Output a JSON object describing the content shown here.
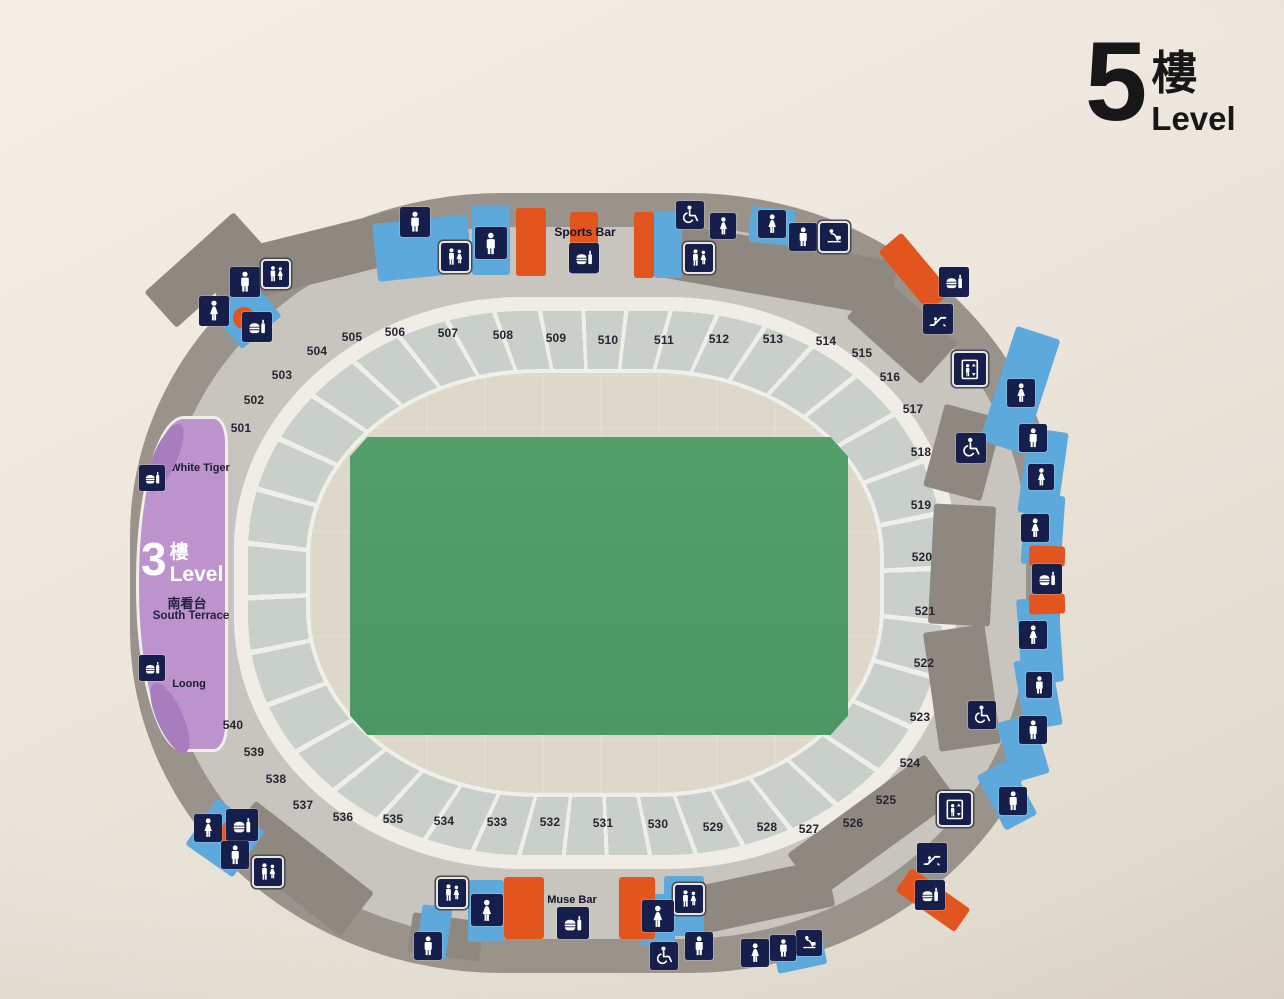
{
  "title": {
    "number": "5",
    "floor_suffix": "樓",
    "level_label": "Level"
  },
  "colors": {
    "blue": "#5ea9dc",
    "orange": "#e2551f",
    "taupe": "#8f8881",
    "purpleDark": "#a87dbd",
    "navy_tile": "#161f4c",
    "field_green": "#4f9a66",
    "terrace_purple": "#bc93cd",
    "band_gray": "#c9cfc9",
    "bowl_beige": "#ded8cb",
    "outer_gray": "#9a938b"
  },
  "map": {
    "labels": [
      {
        "text": "Sports Bar",
        "x": 585,
        "y": 232,
        "fs": 12
      },
      {
        "text": "Muse Bar",
        "x": 572,
        "y": 900,
        "fs": 11
      }
    ],
    "south_terrace": {
      "number": "3",
      "floor_suffix": "樓",
      "level_label": "Level",
      "name_cn": "南看台",
      "name_en": "South Terrace",
      "venues": [
        {
          "label": "White Tiger",
          "x": 61,
          "y": 49
        },
        {
          "label": "Loong",
          "x": 50,
          "y": 265
        }
      ]
    },
    "sections": [
      {
        "n": "501",
        "x": 241,
        "y": 428
      },
      {
        "n": "502",
        "x": 254,
        "y": 400
      },
      {
        "n": "503",
        "x": 282,
        "y": 375
      },
      {
        "n": "504",
        "x": 317,
        "y": 351
      },
      {
        "n": "505",
        "x": 352,
        "y": 337
      },
      {
        "n": "506",
        "x": 395,
        "y": 332
      },
      {
        "n": "507",
        "x": 448,
        "y": 333
      },
      {
        "n": "508",
        "x": 503,
        "y": 335
      },
      {
        "n": "509",
        "x": 556,
        "y": 338
      },
      {
        "n": "510",
        "x": 608,
        "y": 340
      },
      {
        "n": "511",
        "x": 664,
        "y": 340
      },
      {
        "n": "512",
        "x": 719,
        "y": 339
      },
      {
        "n": "513",
        "x": 773,
        "y": 339
      },
      {
        "n": "514",
        "x": 826,
        "y": 341
      },
      {
        "n": "515",
        "x": 862,
        "y": 353
      },
      {
        "n": "516",
        "x": 890,
        "y": 377
      },
      {
        "n": "517",
        "x": 913,
        "y": 409
      },
      {
        "n": "518",
        "x": 921,
        "y": 452
      },
      {
        "n": "519",
        "x": 921,
        "y": 505
      },
      {
        "n": "520",
        "x": 922,
        "y": 557
      },
      {
        "n": "521",
        "x": 925,
        "y": 611
      },
      {
        "n": "522",
        "x": 924,
        "y": 663
      },
      {
        "n": "523",
        "x": 920,
        "y": 717
      },
      {
        "n": "524",
        "x": 910,
        "y": 763
      },
      {
        "n": "525",
        "x": 886,
        "y": 800
      },
      {
        "n": "526",
        "x": 853,
        "y": 823
      },
      {
        "n": "527",
        "x": 809,
        "y": 829
      },
      {
        "n": "528",
        "x": 767,
        "y": 827
      },
      {
        "n": "529",
        "x": 713,
        "y": 827
      },
      {
        "n": "530",
        "x": 658,
        "y": 824
      },
      {
        "n": "531",
        "x": 603,
        "y": 823
      },
      {
        "n": "532",
        "x": 550,
        "y": 822
      },
      {
        "n": "533",
        "x": 497,
        "y": 822
      },
      {
        "n": "534",
        "x": 444,
        "y": 821
      },
      {
        "n": "535",
        "x": 393,
        "y": 819
      },
      {
        "n": "536",
        "x": 343,
        "y": 817
      },
      {
        "n": "537",
        "x": 303,
        "y": 805
      },
      {
        "n": "538",
        "x": 276,
        "y": 779
      },
      {
        "n": "539",
        "x": 254,
        "y": 752
      },
      {
        "n": "540",
        "x": 233,
        "y": 725
      }
    ],
    "icons": [
      {
        "t": "male",
        "x": 245,
        "y": 282,
        "s": 30
      },
      {
        "t": "family",
        "x": 276,
        "y": 274,
        "s": 26,
        "f": 1
      },
      {
        "t": "female",
        "x": 214,
        "y": 311,
        "s": 30
      },
      {
        "t": "food",
        "x": 257,
        "y": 327,
        "s": 30
      },
      {
        "t": "male",
        "x": 415,
        "y": 222,
        "s": 30
      },
      {
        "t": "family",
        "x": 455,
        "y": 257,
        "s": 28,
        "f": 1
      },
      {
        "t": "male",
        "x": 491,
        "y": 243,
        "s": 32
      },
      {
        "t": "food",
        "x": 584,
        "y": 258,
        "s": 30
      },
      {
        "t": "wheelchair",
        "x": 690,
        "y": 215,
        "s": 28
      },
      {
        "t": "female",
        "x": 723,
        "y": 226,
        "s": 26
      },
      {
        "t": "family",
        "x": 699,
        "y": 258,
        "s": 28,
        "f": 1
      },
      {
        "t": "female",
        "x": 772,
        "y": 224,
        "s": 28
      },
      {
        "t": "male",
        "x": 803,
        "y": 237,
        "s": 28
      },
      {
        "t": "babycare",
        "x": 834,
        "y": 237,
        "s": 28,
        "f": 1
      },
      {
        "t": "food",
        "x": 954,
        "y": 282,
        "s": 30
      },
      {
        "t": "escalator",
        "x": 938,
        "y": 319,
        "s": 30
      },
      {
        "t": "elevator",
        "x": 970,
        "y": 369,
        "s": 32,
        "f": 1
      },
      {
        "t": "female",
        "x": 1021,
        "y": 393,
        "s": 28
      },
      {
        "t": "male",
        "x": 1033,
        "y": 438,
        "s": 28
      },
      {
        "t": "wheelchair",
        "x": 971,
        "y": 448,
        "s": 30
      },
      {
        "t": "female",
        "x": 1041,
        "y": 477,
        "s": 26
      },
      {
        "t": "female",
        "x": 1035,
        "y": 528,
        "s": 28
      },
      {
        "t": "food",
        "x": 1047,
        "y": 579,
        "s": 30
      },
      {
        "t": "female",
        "x": 1033,
        "y": 635,
        "s": 28
      },
      {
        "t": "male",
        "x": 1039,
        "y": 685,
        "s": 26
      },
      {
        "t": "wheelchair",
        "x": 982,
        "y": 715,
        "s": 28
      },
      {
        "t": "male",
        "x": 1033,
        "y": 730,
        "s": 28
      },
      {
        "t": "elevator",
        "x": 955,
        "y": 809,
        "s": 32,
        "f": 1
      },
      {
        "t": "male",
        "x": 1013,
        "y": 801,
        "s": 28
      },
      {
        "t": "escalator",
        "x": 932,
        "y": 858,
        "s": 30
      },
      {
        "t": "food",
        "x": 930,
        "y": 895,
        "s": 30
      },
      {
        "t": "babycare",
        "x": 809,
        "y": 943,
        "s": 26
      },
      {
        "t": "male",
        "x": 783,
        "y": 948,
        "s": 26
      },
      {
        "t": "female",
        "x": 755,
        "y": 953,
        "s": 28
      },
      {
        "t": "male",
        "x": 699,
        "y": 946,
        "s": 28
      },
      {
        "t": "wheelchair",
        "x": 664,
        "y": 956,
        "s": 28
      },
      {
        "t": "family",
        "x": 689,
        "y": 899,
        "s": 28,
        "f": 1
      },
      {
        "t": "female",
        "x": 658,
        "y": 916,
        "s": 32
      },
      {
        "t": "food",
        "x": 573,
        "y": 923,
        "s": 32
      },
      {
        "t": "female",
        "x": 487,
        "y": 910,
        "s": 32
      },
      {
        "t": "family",
        "x": 452,
        "y": 893,
        "s": 28,
        "f": 1
      },
      {
        "t": "male",
        "x": 428,
        "y": 946,
        "s": 28
      },
      {
        "t": "female",
        "x": 208,
        "y": 828,
        "s": 28
      },
      {
        "t": "food",
        "x": 242,
        "y": 825,
        "s": 32
      },
      {
        "t": "male",
        "x": 235,
        "y": 855,
        "s": 28
      },
      {
        "t": "family",
        "x": 268,
        "y": 872,
        "s": 28,
        "f": 1
      },
      {
        "t": "food",
        "x": 152,
        "y": 478,
        "s": 26
      },
      {
        "t": "food",
        "x": 152,
        "y": 668,
        "s": 26
      }
    ],
    "patches": [
      {
        "c": "taupe",
        "x": 310,
        "y": 258,
        "w": 200,
        "h": 52,
        "r": -14
      },
      {
        "c": "taupe",
        "x": 770,
        "y": 268,
        "w": 250,
        "h": 56,
        "r": 10
      },
      {
        "c": "taupe",
        "x": 902,
        "y": 330,
        "w": 100,
        "h": 55,
        "r": 42
      },
      {
        "c": "taupe",
        "x": 963,
        "y": 452,
        "w": 60,
        "h": 85,
        "r": 15
      },
      {
        "c": "taupe",
        "x": 962,
        "y": 565,
        "w": 62,
        "h": 120,
        "r": 3
      },
      {
        "c": "taupe",
        "x": 962,
        "y": 688,
        "w": 62,
        "h": 120,
        "r": -8
      },
      {
        "c": "taupe",
        "x": 872,
        "y": 826,
        "w": 170,
        "h": 55,
        "r": -36
      },
      {
        "c": "taupe",
        "x": 757,
        "y": 898,
        "w": 150,
        "h": 48,
        "r": -12
      },
      {
        "c": "taupe",
        "x": 446,
        "y": 937,
        "w": 72,
        "h": 40,
        "r": 8
      },
      {
        "c": "taupe",
        "x": 298,
        "y": 868,
        "w": 150,
        "h": 55,
        "r": 38
      },
      {
        "c": "taupe",
        "x": 205,
        "y": 270,
        "w": 120,
        "h": 48,
        "r": -42
      },
      {
        "c": "blue",
        "x": 422,
        "y": 248,
        "w": 95,
        "h": 58,
        "r": -6
      },
      {
        "c": "blue",
        "x": 491,
        "y": 240,
        "w": 38,
        "h": 70,
        "r": 0
      },
      {
        "c": "blue",
        "x": 668,
        "y": 245,
        "w": 28,
        "h": 66,
        "r": 0
      },
      {
        "c": "blue",
        "x": 772,
        "y": 226,
        "w": 44,
        "h": 36,
        "r": 6
      },
      {
        "c": "blue",
        "x": 1020,
        "y": 390,
        "w": 46,
        "h": 120,
        "r": 18
      },
      {
        "c": "blue",
        "x": 1043,
        "y": 472,
        "w": 40,
        "h": 85,
        "r": 8
      },
      {
        "c": "blue",
        "x": 1043,
        "y": 530,
        "w": 40,
        "h": 70,
        "r": 4
      },
      {
        "c": "blue",
        "x": 1040,
        "y": 640,
        "w": 42,
        "h": 85,
        "r": -4
      },
      {
        "c": "blue",
        "x": 1038,
        "y": 693,
        "w": 38,
        "h": 70,
        "r": -10
      },
      {
        "c": "blue",
        "x": 1023,
        "y": 748,
        "w": 38,
        "h": 62,
        "r": -16
      },
      {
        "c": "blue",
        "x": 1007,
        "y": 795,
        "w": 36,
        "h": 62,
        "r": -28
      },
      {
        "c": "blue",
        "x": 486,
        "y": 911,
        "w": 36,
        "h": 62,
        "r": 0
      },
      {
        "c": "blue",
        "x": 658,
        "y": 920,
        "w": 34,
        "h": 52,
        "r": 0
      },
      {
        "c": "blue",
        "x": 684,
        "y": 906,
        "w": 40,
        "h": 60,
        "r": 0
      },
      {
        "c": "blue",
        "x": 800,
        "y": 955,
        "w": 50,
        "h": 28,
        "r": -12
      },
      {
        "c": "blue",
        "x": 434,
        "y": 932,
        "w": 30,
        "h": 52,
        "r": 8
      },
      {
        "c": "blue",
        "x": 247,
        "y": 315,
        "w": 52,
        "h": 46,
        "r": -40
      },
      {
        "c": "blue",
        "x": 225,
        "y": 838,
        "w": 58,
        "h": 56,
        "r": 35
      },
      {
        "c": "orange",
        "x": 531,
        "y": 242,
        "w": 30,
        "h": 68,
        "r": 0
      },
      {
        "c": "orange",
        "x": 584,
        "y": 243,
        "w": 28,
        "h": 62,
        "r": 0
      },
      {
        "c": "orange",
        "x": 644,
        "y": 245,
        "w": 20,
        "h": 66,
        "r": 0
      },
      {
        "c": "orange",
        "x": 915,
        "y": 272,
        "w": 30,
        "h": 78,
        "r": -40
      },
      {
        "c": "orange",
        "x": 1047,
        "y": 556,
        "w": 36,
        "h": 20,
        "r": 2
      },
      {
        "c": "orange",
        "x": 1047,
        "y": 604,
        "w": 36,
        "h": 20,
        "r": -2
      },
      {
        "c": "orange",
        "x": 933,
        "y": 900,
        "w": 28,
        "h": 72,
        "r": -55
      },
      {
        "c": "orange",
        "x": 524,
        "y": 908,
        "w": 40,
        "h": 62,
        "r": 0
      },
      {
        "c": "orange",
        "x": 637,
        "y": 908,
        "w": 36,
        "h": 62,
        "r": 0
      },
      {
        "c": "orange",
        "x": 244,
        "y": 318,
        "w": 22,
        "h": 22,
        "r": 0,
        "round": 1
      },
      {
        "c": "orange",
        "x": 233,
        "y": 833,
        "w": 26,
        "h": 26,
        "r": 0,
        "round": 1
      },
      {
        "c": "purpleDark",
        "x": 165,
        "y": 458,
        "w": 24,
        "h": 74,
        "r": 24,
        "round": 1,
        "z": 26
      },
      {
        "c": "purpleDark",
        "x": 170,
        "y": 718,
        "w": 26,
        "h": 76,
        "r": -24,
        "round": 1,
        "z": 26
      }
    ]
  }
}
